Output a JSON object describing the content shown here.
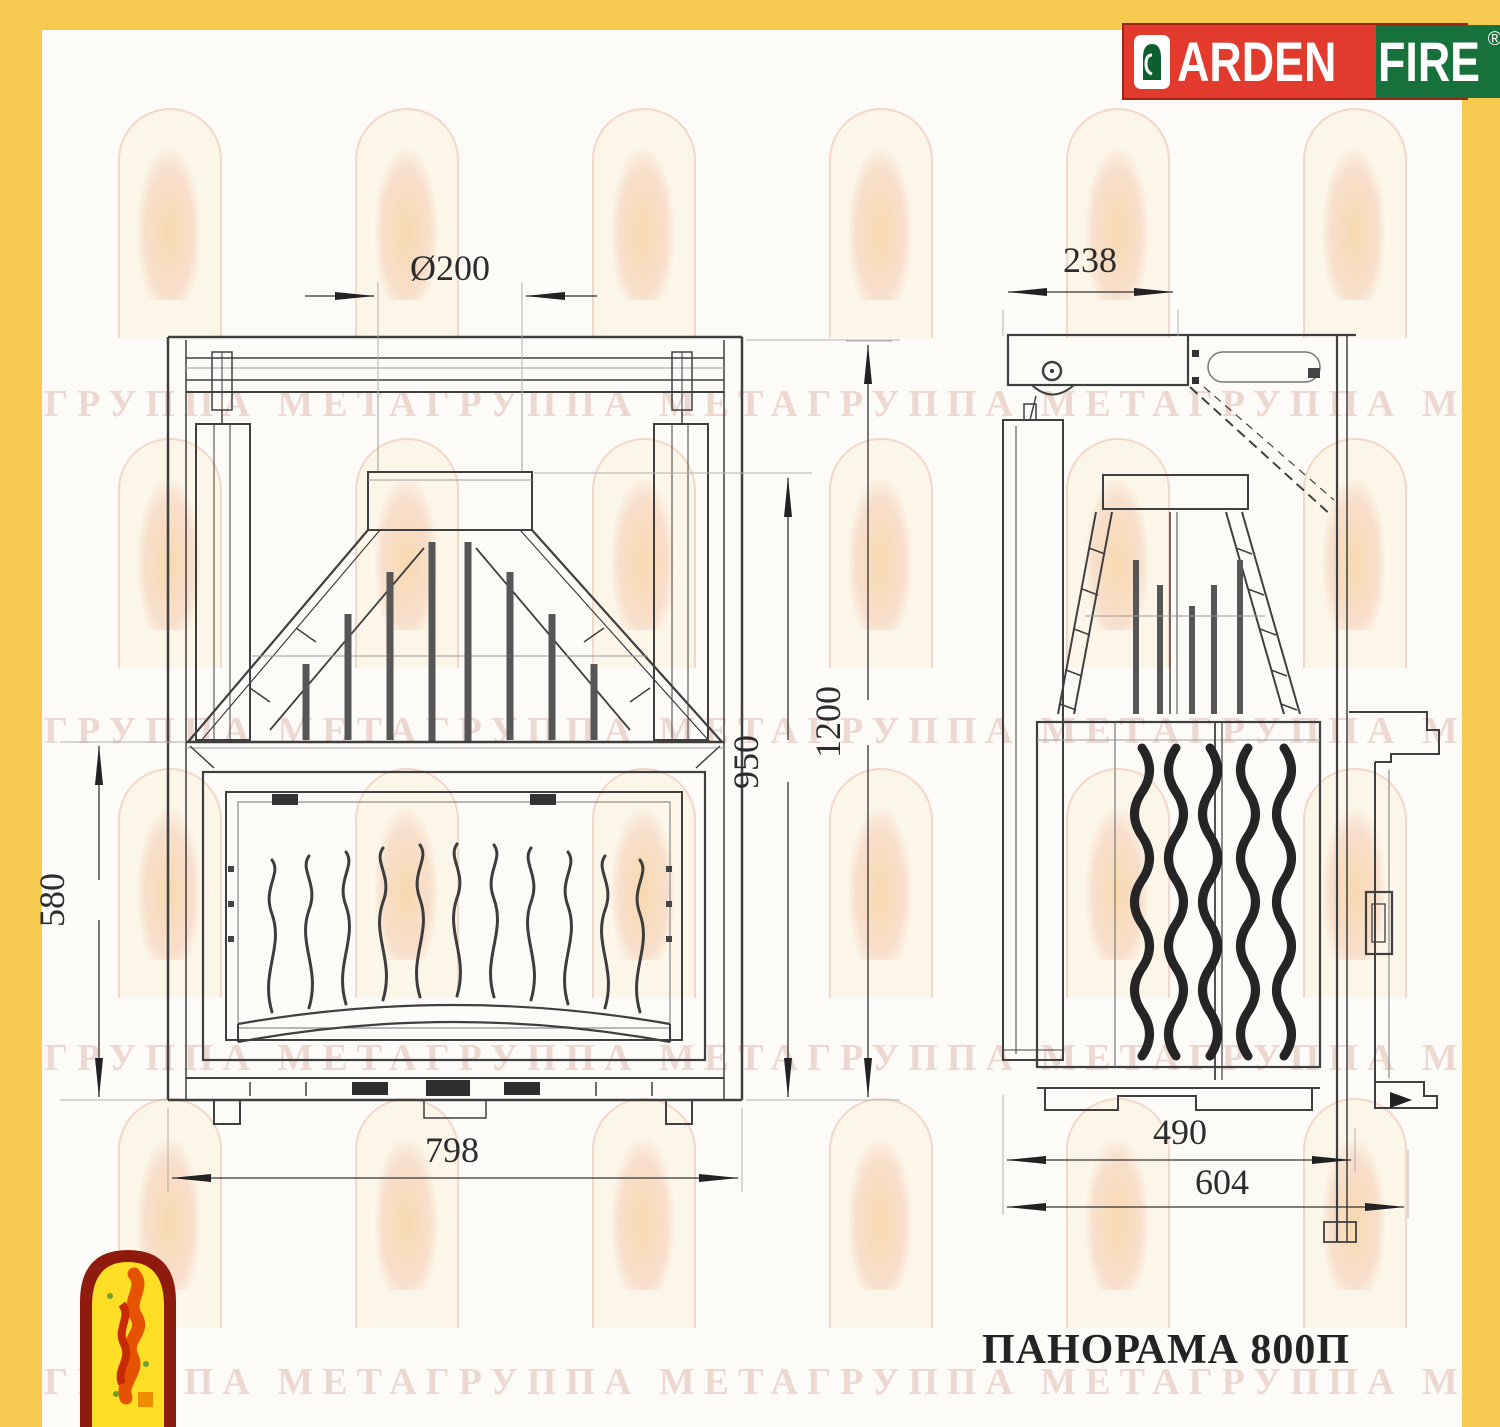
{
  "brand": {
    "name_left": "ARDEN",
    "name_right": "FIRE",
    "registered": "®"
  },
  "title": "ПАНОРАМА 800П",
  "watermark": {
    "text": "ГРУППА МЕТАГРУППА МЕТАГРУППА МЕТАГРУППА МЕТА"
  },
  "dimensions": {
    "flue_diameter": "Ø200",
    "top_depth": "238",
    "total_height": "1200",
    "hood_height": "950",
    "firebox_height": "580",
    "width": "798",
    "body_depth": "490",
    "total_depth": "604"
  },
  "colors": {
    "frame_yellow": "#F6C94F",
    "brand_red": "#E23A2C",
    "brand_green": "#17713A",
    "drawing_line": "#3F3F3F",
    "watermark_pink": "#E8C2B8"
  }
}
